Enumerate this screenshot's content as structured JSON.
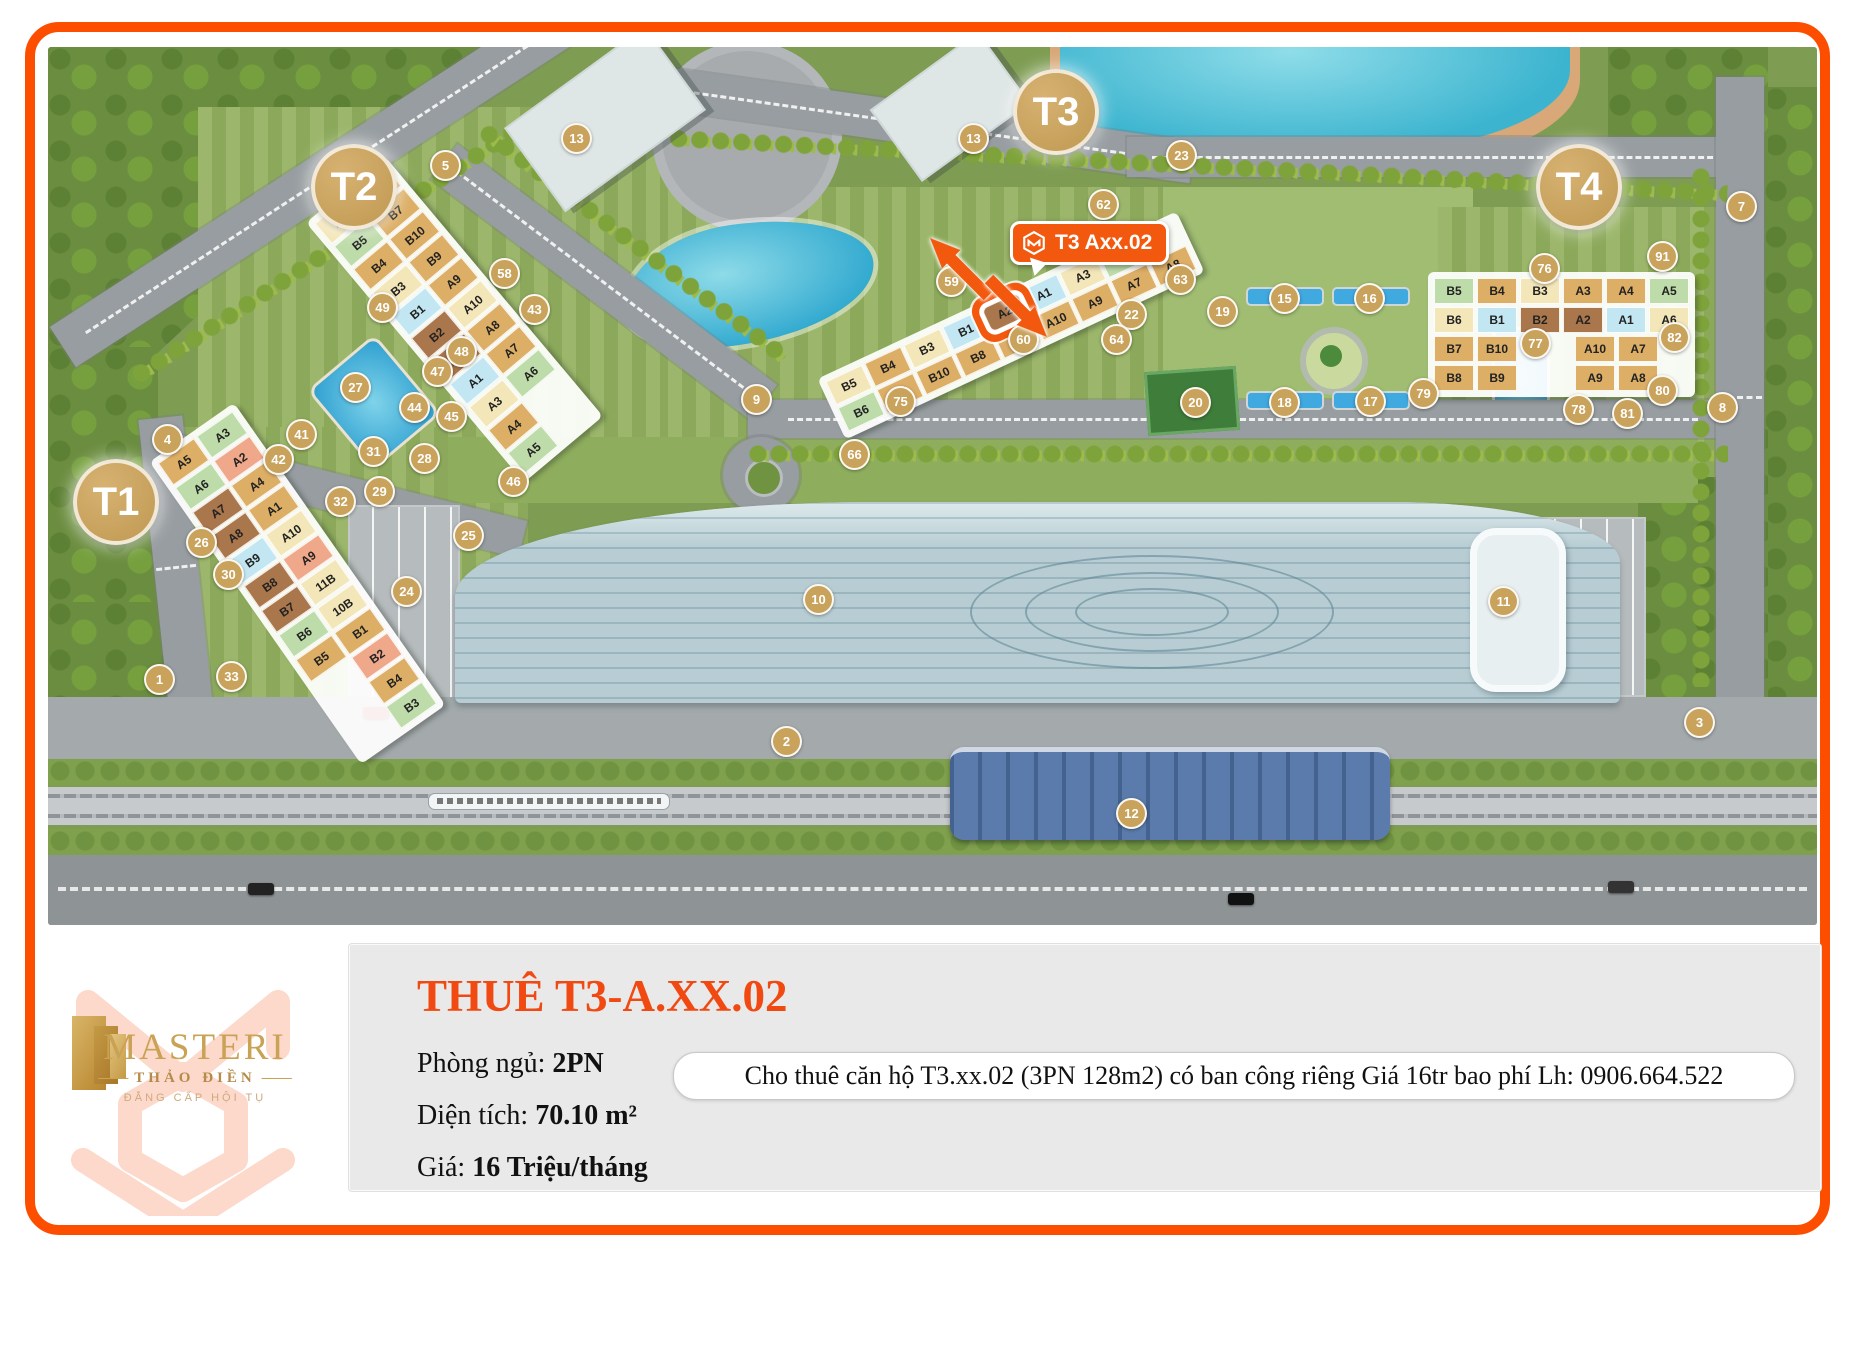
{
  "theme": {
    "accent_orange": "#fd4e00",
    "callout_orange": "#f2590f",
    "marker_tan": "#c9a25c",
    "title_orange": "#f04a12",
    "panel_gray": "#e9e9e9",
    "map_green": "#7e9c52",
    "lake_blue": "#3cb4cf",
    "mall_blue": "#b7cdd3",
    "metro_blue": "#50719f",
    "brand_gold": "#c9a254",
    "unit_palette": {
      "tan": "#dcae66",
      "cream": "#f3e6b8",
      "green": "#bedcaa",
      "salmon": "#f0a88b",
      "brown": "#aa764c",
      "blue": "#c3e7f2",
      "pale": "#efe2ab"
    }
  },
  "map": {
    "towers": [
      {
        "label": "T1",
        "x": 64,
        "y": 451
      },
      {
        "label": "T2",
        "x": 302,
        "y": 136
      },
      {
        "label": "T3",
        "x": 1004,
        "y": 61
      },
      {
        "label": "T4",
        "x": 1527,
        "y": 136
      }
    ],
    "callout": {
      "label": "T3 Axx.02"
    },
    "highlighted_unit": "A2",
    "markers": [
      {
        "n": "1",
        "x": 110,
        "y": 631
      },
      {
        "n": "2",
        "x": 737,
        "y": 693
      },
      {
        "n": "3",
        "x": 1650,
        "y": 674
      },
      {
        "n": "4",
        "x": 118,
        "y": 391
      },
      {
        "n": "5",
        "x": 396,
        "y": 117
      },
      {
        "n": "7",
        "x": 1692,
        "y": 158
      },
      {
        "n": "8",
        "x": 1673,
        "y": 359
      },
      {
        "n": "9",
        "x": 707,
        "y": 351
      },
      {
        "n": "10",
        "x": 769,
        "y": 551
      },
      {
        "n": "11",
        "x": 1454,
        "y": 553
      },
      {
        "n": "12",
        "x": 1082,
        "y": 765
      },
      {
        "n": "13",
        "x": 527,
        "y": 90
      },
      {
        "n": "13",
        "x": 924,
        "y": 90
      },
      {
        "n": "15",
        "x": 1235,
        "y": 250
      },
      {
        "n": "16",
        "x": 1320,
        "y": 250
      },
      {
        "n": "17",
        "x": 1321,
        "y": 353
      },
      {
        "n": "18",
        "x": 1235,
        "y": 354
      },
      {
        "n": "19",
        "x": 1173,
        "y": 263
      },
      {
        "n": "20",
        "x": 1146,
        "y": 354
      },
      {
        "n": "22",
        "x": 1082,
        "y": 266
      },
      {
        "n": "23",
        "x": 1132,
        "y": 107
      },
      {
        "n": "24",
        "x": 357,
        "y": 543
      },
      {
        "n": "25",
        "x": 419,
        "y": 487
      },
      {
        "n": "26",
        "x": 152,
        "y": 494
      },
      {
        "n": "27",
        "x": 306,
        "y": 339
      },
      {
        "n": "28",
        "x": 375,
        "y": 410
      },
      {
        "n": "29",
        "x": 330,
        "y": 443
      },
      {
        "n": "30",
        "x": 179,
        "y": 526
      },
      {
        "n": "31",
        "x": 324,
        "y": 403
      },
      {
        "n": "32",
        "x": 291,
        "y": 453
      },
      {
        "n": "33",
        "x": 182,
        "y": 628
      },
      {
        "n": "41",
        "x": 252,
        "y": 386
      },
      {
        "n": "42",
        "x": 229,
        "y": 411
      },
      {
        "n": "43",
        "x": 485,
        "y": 261
      },
      {
        "n": "44",
        "x": 365,
        "y": 359
      },
      {
        "n": "45",
        "x": 402,
        "y": 368
      },
      {
        "n": "46",
        "x": 464,
        "y": 433
      },
      {
        "n": "47",
        "x": 388,
        "y": 323
      },
      {
        "n": "48",
        "x": 412,
        "y": 303
      },
      {
        "n": "49",
        "x": 333,
        "y": 259
      },
      {
        "n": "58",
        "x": 455,
        "y": 225
      },
      {
        "n": "59",
        "x": 902,
        "y": 233
      },
      {
        "n": "60",
        "x": 974,
        "y": 291
      },
      {
        "n": "62",
        "x": 1054,
        "y": 156
      },
      {
        "n": "63",
        "x": 1131,
        "y": 231
      },
      {
        "n": "64",
        "x": 1067,
        "y": 291
      },
      {
        "n": "66",
        "x": 805,
        "y": 406
      },
      {
        "n": "75",
        "x": 851,
        "y": 353
      },
      {
        "n": "76",
        "x": 1495,
        "y": 220
      },
      {
        "n": "77",
        "x": 1486,
        "y": 295
      },
      {
        "n": "78",
        "x": 1529,
        "y": 361
      },
      {
        "n": "79",
        "x": 1374,
        "y": 345
      },
      {
        "n": "80",
        "x": 1613,
        "y": 342
      },
      {
        "n": "81",
        "x": 1578,
        "y": 365
      },
      {
        "n": "82",
        "x": 1625,
        "y": 289
      },
      {
        "n": "91",
        "x": 1613,
        "y": 208
      }
    ],
    "clusters": [
      {
        "name": "T1",
        "x": 198,
        "y": 352,
        "rot": -35,
        "axis": "cols",
        "groups": [
          [
            {
              "label": "A5",
              "c": "tan"
            },
            {
              "label": "A6",
              "c": "green"
            },
            {
              "label": "A7",
              "c": "brown"
            },
            {
              "label": "A8",
              "c": "brown"
            },
            {
              "label": "B9",
              "c": "blue"
            },
            {
              "label": "B8",
              "c": "brown"
            },
            {
              "label": "B7",
              "c": "brown"
            },
            {
              "label": "B6",
              "c": "green"
            },
            {
              "label": "B5",
              "c": "tan"
            }
          ],
          [
            {
              "label": "A3",
              "c": "green"
            },
            {
              "label": "A2",
              "c": "salmon"
            },
            {
              "label": "A4",
              "c": "tan"
            },
            {
              "label": "A1",
              "c": "tan"
            },
            {
              "label": "A10",
              "c": "cream"
            },
            {
              "label": "A9",
              "c": "salmon"
            },
            {
              "label": "11B",
              "c": "cream"
            },
            {
              "label": "10B",
              "c": "cream"
            },
            {
              "label": "B1",
              "c": "tan"
            },
            {
              "label": "B2",
              "c": "salmon"
            },
            {
              "label": "B4",
              "c": "tan"
            },
            {
              "label": "B3",
              "c": "green"
            }
          ]
        ]
      },
      {
        "name": "T2",
        "x": 355,
        "y": 103,
        "rot": -40,
        "axis": "cols",
        "groups": [
          [
            {
              "label": "B6",
              "c": "cream"
            },
            {
              "label": "B5",
              "c": "green"
            },
            {
              "label": "B4",
              "c": "tan"
            },
            {
              "label": "B3",
              "c": "cream"
            },
            {
              "label": "B1",
              "c": "blue"
            },
            {
              "label": "B2",
              "c": "brown"
            },
            {
              "label": "A2",
              "c": "brown"
            },
            {
              "label": "A1",
              "c": "blue"
            },
            {
              "label": "A3",
              "c": "cream"
            },
            {
              "label": "A4",
              "c": "tan"
            },
            {
              "label": "A5",
              "c": "green"
            }
          ],
          [
            {
              "label": "B8",
              "c": "tan"
            },
            {
              "label": "B7",
              "c": "tan"
            },
            {
              "label": "B10",
              "c": "tan"
            },
            {
              "label": "B9",
              "c": "tan"
            },
            {
              "label": "A9",
              "c": "tan"
            },
            {
              "label": "A10",
              "c": "cream"
            },
            {
              "label": "A8",
              "c": "tan"
            },
            {
              "label": "A7",
              "c": "tan"
            },
            {
              "label": "A6",
              "c": "green"
            }
          ]
        ]
      },
      {
        "name": "T3",
        "x": 765,
        "y": 245,
        "rot": -25,
        "axis": "rows",
        "groups": [
          [
            {
              "label": "B5",
              "c": "cream"
            },
            {
              "label": "B4",
              "c": "tan"
            },
            {
              "label": "B3",
              "c": "cream"
            },
            {
              "label": "B1",
              "c": "blue"
            },
            {
              "label": "A2",
              "c": "brown",
              "hl": true
            },
            {
              "label": "A1",
              "c": "blue"
            },
            {
              "label": "A3",
              "c": "cream"
            },
            {
              "label": "A5",
              "c": "green"
            }
          ],
          [
            {
              "label": "B6",
              "c": "green"
            },
            {
              "label": "B7",
              "c": "tan"
            },
            {
              "label": "B10",
              "c": "tan"
            },
            {
              "label": "B8",
              "c": "tan"
            },
            {
              "label": "B9",
              "c": "tan"
            },
            {
              "label": "A10",
              "c": "tan"
            },
            {
              "label": "A9",
              "c": "tan"
            },
            {
              "label": "A7",
              "c": "tan"
            },
            {
              "label": "A8",
              "c": "tan"
            }
          ]
        ]
      },
      {
        "name": "T4",
        "x": 1380,
        "y": 225,
        "rot": 0,
        "axis": "rows",
        "groups": [
          [
            {
              "label": "B5",
              "c": "green"
            },
            {
              "label": "B4",
              "c": "tan"
            },
            {
              "label": "B3",
              "c": "cream"
            },
            {
              "label": "A3",
              "c": "tan"
            },
            {
              "label": "A4",
              "c": "tan"
            },
            {
              "label": "A5",
              "c": "green"
            }
          ],
          [
            {
              "label": "B6",
              "c": "cream"
            },
            {
              "label": "B1",
              "c": "blue"
            },
            {
              "label": "B2",
              "c": "brown"
            },
            {
              "label": "A2",
              "c": "brown"
            },
            {
              "label": "A1",
              "c": "blue"
            },
            {
              "label": "A6",
              "c": "cream"
            }
          ],
          [
            {
              "label": "B7",
              "c": "tan"
            },
            {
              "label": "B10",
              "c": "tan"
            },
            {
              "label": "",
              "c": "gap"
            },
            {
              "label": "A10",
              "c": "tan"
            },
            {
              "label": "A7",
              "c": "tan"
            }
          ],
          [
            {
              "label": "B8",
              "c": "tan"
            },
            {
              "label": "B9",
              "c": "tan"
            },
            {
              "label": "",
              "c": "gap"
            },
            {
              "label": "A9",
              "c": "tan"
            },
            {
              "label": "A8",
              "c": "tan"
            }
          ]
        ]
      }
    ]
  },
  "info_panel": {
    "title": "THUÊ T3-A.XX.02",
    "rows": [
      {
        "label": "Phòng ngủ:",
        "value": "2PN"
      },
      {
        "label": "Diện tích:",
        "value": "70.10 m²"
      },
      {
        "label": "Giá:",
        "value": "16 Triệu/tháng"
      }
    ],
    "tooltip": "Cho thuê căn hộ T3.xx.02 (3PN 128m2) có ban công riêng Giá 16tr bao phí Lh: 0906.664.522"
  },
  "logo": {
    "brand": "MASTERI",
    "sub": "THẢO ĐIỀN",
    "tagline": "ĐẲNG CẤP HỘI TỤ"
  }
}
